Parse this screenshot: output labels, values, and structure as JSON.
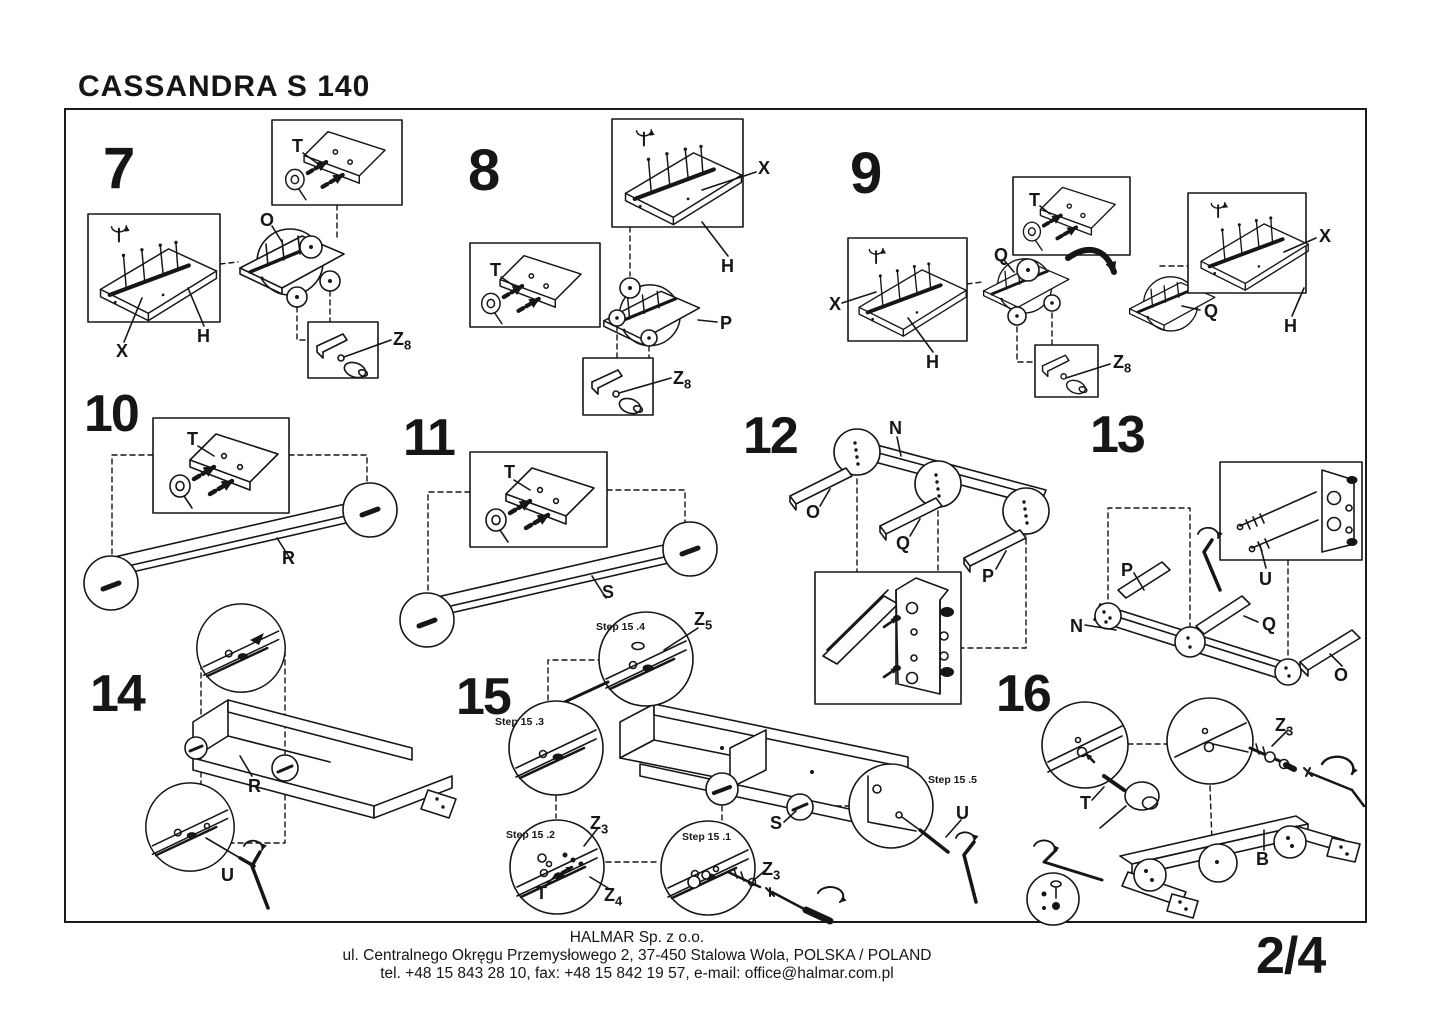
{
  "title": "CASSANDRA S  140",
  "page_number": "2/4",
  "footer": {
    "company": "HALMAR Sp. z o.o.",
    "address": "ul. Centralnego Okręgu Przemysłowego 2, 37-450 Stalowa Wola, POLSKA / POLAND",
    "contact": "tel. +48 15 843 28 10, fax: +48 15 842 19 57, e-mail: office@halmar.com.pl"
  },
  "parts": {
    "T": "T",
    "O": "O",
    "X": "X",
    "H": "H",
    "P": "P",
    "Q": "Q",
    "R": "R",
    "S": "S",
    "N": "N",
    "U": "U",
    "B": "B",
    "Z": "Z"
  },
  "subscripts": {
    "z8": "8",
    "z5": "5",
    "z4": "4",
    "z3": "3"
  },
  "steps": {
    "step7": {
      "number": "7"
    },
    "step8": {
      "number": "8"
    },
    "step9": {
      "number": "9"
    },
    "step10": {
      "number": "10"
    },
    "step11": {
      "number": "11"
    },
    "step12": {
      "number": "12"
    },
    "step13": {
      "number": "13"
    },
    "step14": {
      "number": "14"
    },
    "step15": {
      "number": "15",
      "substeps": {
        "s1": "Step 15 .1",
        "s2": "Step 15 .2",
        "s3": "Step 15 .3",
        "s4": "Step 15 .4",
        "s5": "Step 15 .5"
      }
    },
    "step16": {
      "number": "16"
    }
  }
}
